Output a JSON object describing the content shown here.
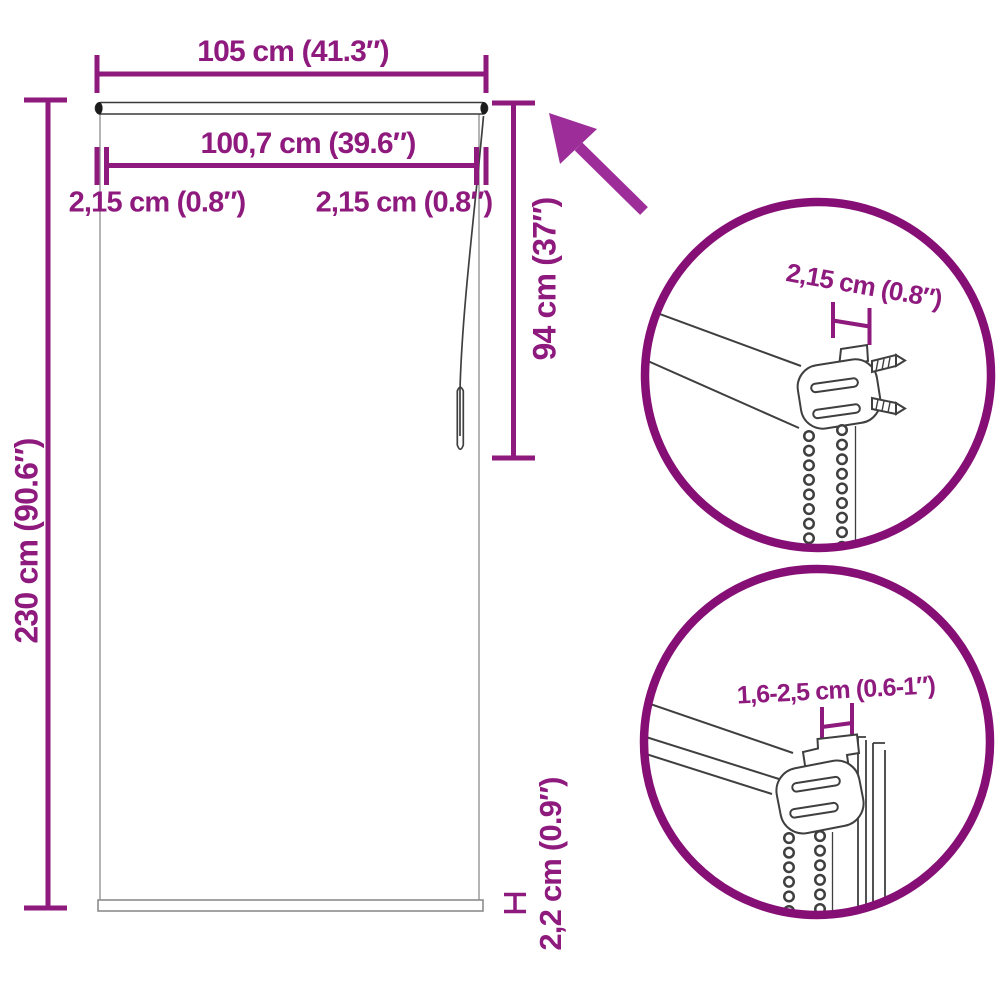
{
  "labels": {
    "total_width": "105 cm (41.3″)",
    "fabric_width": "100,7 cm (39.6″)",
    "left_end_gap": "2,15 cm (0.8″)",
    "right_end_gap": "2,15 cm (0.8″)",
    "total_height": "230 cm (90.6″)",
    "chain_drop": "94 cm (37″)",
    "bottom_bar_height": "2,2 cm (0.9″)"
  },
  "detail_top": {
    "label": "2,15 cm (0.8″)"
  },
  "detail_bottom": {
    "label": "1,6-2,5 cm (0.6-1″)"
  },
  "colors": {
    "dimension_purple": "#8e1a7e",
    "arrow_purple": "#9d2d98",
    "circle_purple": "#860f76",
    "line_art_gray": "#3f3f3f"
  }
}
